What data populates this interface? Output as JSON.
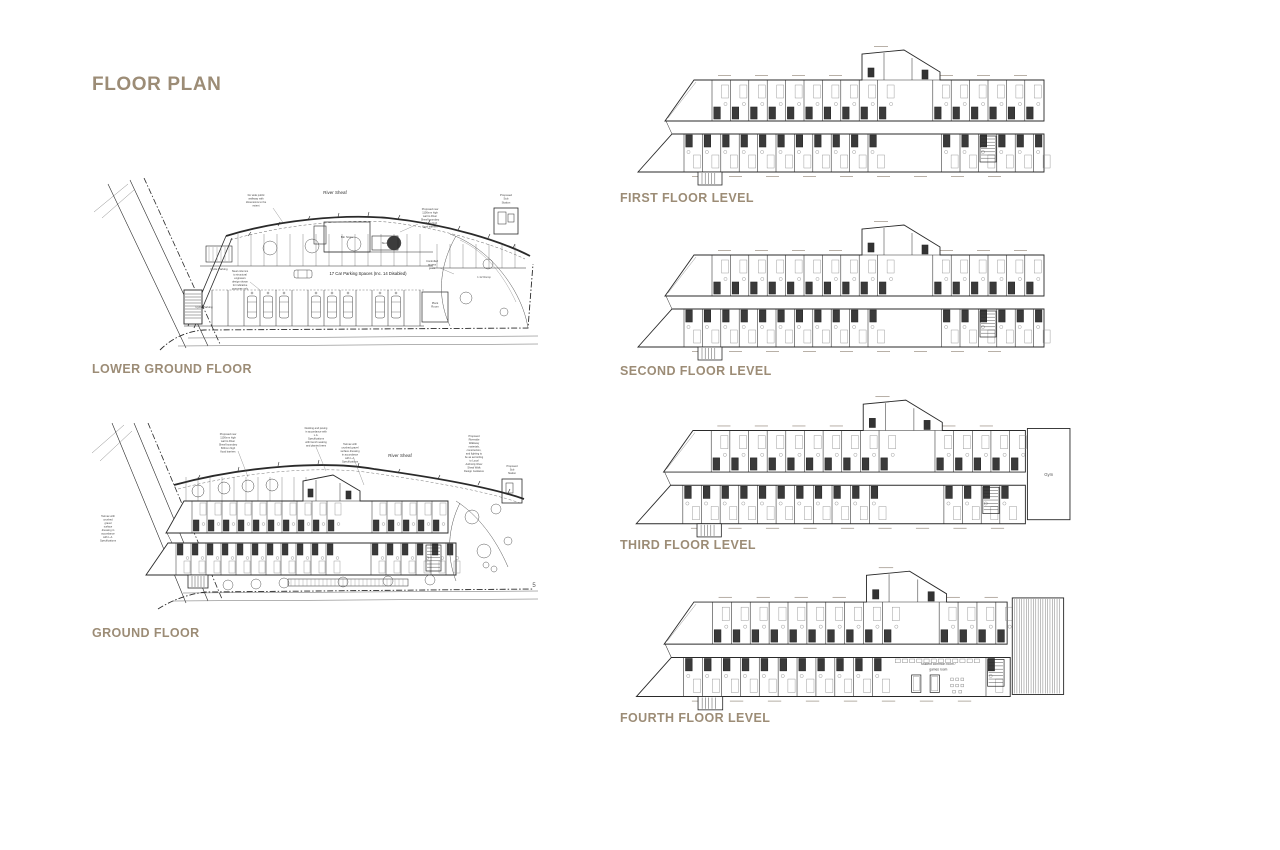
{
  "page": {
    "title": "FLOOR PLAN",
    "background": "#ffffff",
    "accent": "#9c8c76",
    "ink": "#2a2a2a"
  },
  "plans": {
    "lower_ground": {
      "caption": "LOWER GROUND FLOOR",
      "labels": {
        "river": "River Sheaf",
        "parking": "17 Car Parking Spaces (Inc. 14 Disabled)",
        "cycle_upper": "Cycle Parking",
        "cycle_lower": "Cycle Parking",
        "bin_store": "Bin Store",
        "store": "Store",
        "plant_room": "Plant Room",
        "sub_station": "Proposed Sub Station",
        "access_gates": "Controlled access gates",
        "ramp": "1:12 Ramp",
        "walkway_note": "3m wide public walkway with dimensions to the extent",
        "wall_note": "Proposed new 1100mm high wall to River Sheaf boundary 600mm high flood barriers",
        "columns_note": "Steel columns to structural engineers design shown for indicative purposes only"
      }
    },
    "ground": {
      "caption": "GROUND FLOOR",
      "labels": {
        "river": "River Sheaf",
        "decking_note": "Decking and paving in accordance with L.A. Specifications with bench seating and planted trees",
        "wall_note": "Proposed new 1100mm high wall to River Sheaf boundary 600mm high flood barriers",
        "tarmac_note": "Tarmac with crushed gravel surface dressing in accordance with L.A. Specifications",
        "riverside_note": "Proposed Riverside Walkway materials, construction, and lighting to be as according to Local Authority River Sheaf Walk Design Guidance",
        "tarmac_note_left": "Tarmac with crushed gravel surface dressing in accordance with L.A. Specifications",
        "sub_station": "Proposed Sub Station",
        "numeral": "5"
      }
    },
    "first": {
      "caption": "FIRST FLOOR LEVEL"
    },
    "second": {
      "caption": "SECOND FLOOR LEVEL"
    },
    "third": {
      "caption": "THIRD FLOOR LEVEL",
      "labels": {
        "gym": "Gym"
      }
    },
    "fourth": {
      "caption": "FOURTH FLOOR LEVEL",
      "labels": {
        "common_1": "student common room /",
        "common_2": "games room"
      }
    }
  }
}
